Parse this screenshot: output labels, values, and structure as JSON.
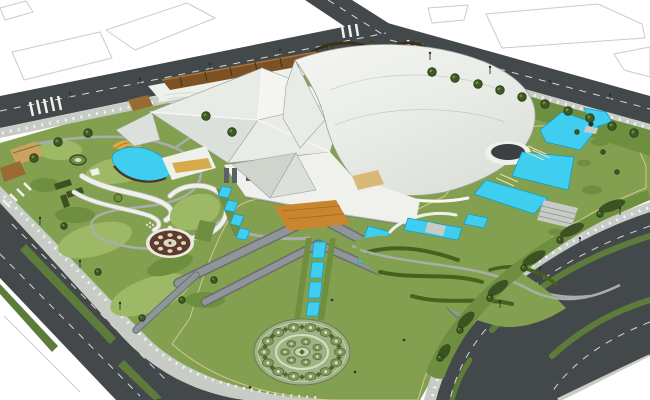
{
  "scene": {
    "title": "Aerial 3D architectural rendering of a cultural-center site plan with landscaped park, pools and perimeter roads",
    "type": "3d-render",
    "view": "aerial-perspective",
    "features": [
      "main-building-faceted-white-roof",
      "curved-shell-roof",
      "forecourt-plaza-with-chevron-walkways",
      "central-reflecting-water-channels",
      "circular-mandala-parterre",
      "cascading-turquoise-pools-east",
      "kidney-pool-with-gold-terrace-west",
      "serpentine-white-garden-walls",
      "circular-flower-bed",
      "pavilion-row-with-terracotta-roof",
      "hedge-maze-garden",
      "terraced-hedge-mounds",
      "sculpture-group-on-platform",
      "wooden-entrance-deck",
      "perimeter-avenues-with-green-medians",
      "street-tree-rows",
      "vacant-plots-outlines",
      "pedestrians"
    ]
  },
  "palette": {
    "bg": "#ffffff",
    "plane_outline": "#c9ccc8",
    "asphalt": "#43484b",
    "lane_line": "#d8d9d4",
    "sidewalk": "#c8ccc6",
    "curb_tick": "#f1f2ee",
    "median_green": "#5d7c3c",
    "grass_base": "#83a050",
    "grass_light": "#9db965",
    "grass_dark": "#6e8f3f",
    "hedge_dark": "#3c5222",
    "hedge_line": "#47621f",
    "hedge_brown": "#3a2e18",
    "tree_dark": "#3f5a28",
    "tree_rim": "#2c4018",
    "water": "#3fcef0",
    "water_edge": "#179ec2",
    "cascade_tan": "#e8dcae",
    "sand": "#eadfb6",
    "sand_dot": "#cdb173",
    "sand_border": "#d6c692",
    "roof_bright": "#f4f5f2",
    "roof_light": "#e9ece6",
    "roof_mid": "#dce0da",
    "roof_shade": "#cfd4cd",
    "roof_panel": "#c6cbc5",
    "roof_edge": "#9ba19e",
    "fascia": "#f8f9f6",
    "facade": "#f0f1ed",
    "window_dark": "#5a6066",
    "shadow": "#6a6f72",
    "wood_amber": "#c8862e",
    "wood_rib": "#a56a1e",
    "facade_tan": "#d9b97a",
    "gold_terrace": "#d9a94e",
    "terracotta": "#7c5124",
    "terracotta_light": "#9a6a33",
    "path_gray": "#a9aeac",
    "ramp_dark": "#686e71",
    "ramp_gray": "#8f9598",
    "deck_white": "#eef0ea",
    "ribbon_edge": "#b9bdb6",
    "oval_dark": "#3b4043",
    "sculpture": "#2e2a26",
    "mandala_base": "#9fb284",
    "mandala_rim": "#6b7a55",
    "mandala_ring": "#d7dec2",
    "rosette": "#7e9a5e",
    "rosette_dark": "#4e6630",
    "rosette_dot": "#dfe5cb",
    "mandala_center": "#c9d3ae",
    "parterre_ring": "#ece9e0",
    "parterre_brown": "#5e3b2c",
    "parterre_center": "#ded8c8",
    "maze_tan": "#c8a45e",
    "figure_dark": "#35322e"
  }
}
